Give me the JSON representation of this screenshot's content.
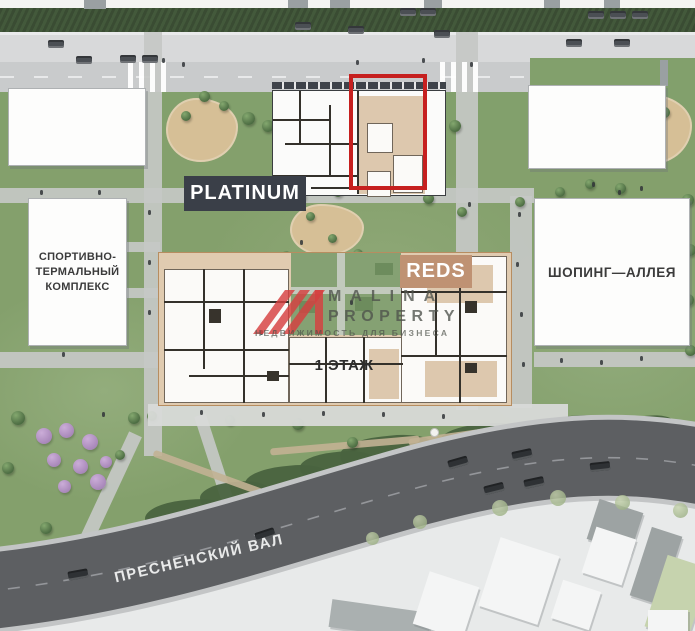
{
  "labels": {
    "platinum": "PLATINUM",
    "reds": "REDS",
    "sport_complex_lines": [
      "СПОРТИВНО-",
      "ТЕРМАЛЬНЫЙ",
      "КОМПЛЕКС"
    ],
    "shopping_alley": "ШОПИНГ—АЛЛЕЯ",
    "floor": "1 ЭТАЖ",
    "street": "ПРЕСНЕНСКИЙ ВАЛ"
  },
  "watermark": {
    "brand_top": "MALINA",
    "brand_bottom": "PROPERTY",
    "tagline": "НЕДВИЖИМОСТЬ ДЛЯ БИЗНЕСА"
  },
  "colors": {
    "highlight_red": "#c6201f",
    "platinum_label_bg": "#3a3f48",
    "reds_label_bg": "#bf9273",
    "plan_tan": "#ddc8ae",
    "road_dark": "#5d5f62",
    "watermark_red": "#d64040",
    "lawn_green": "#86a26e"
  }
}
